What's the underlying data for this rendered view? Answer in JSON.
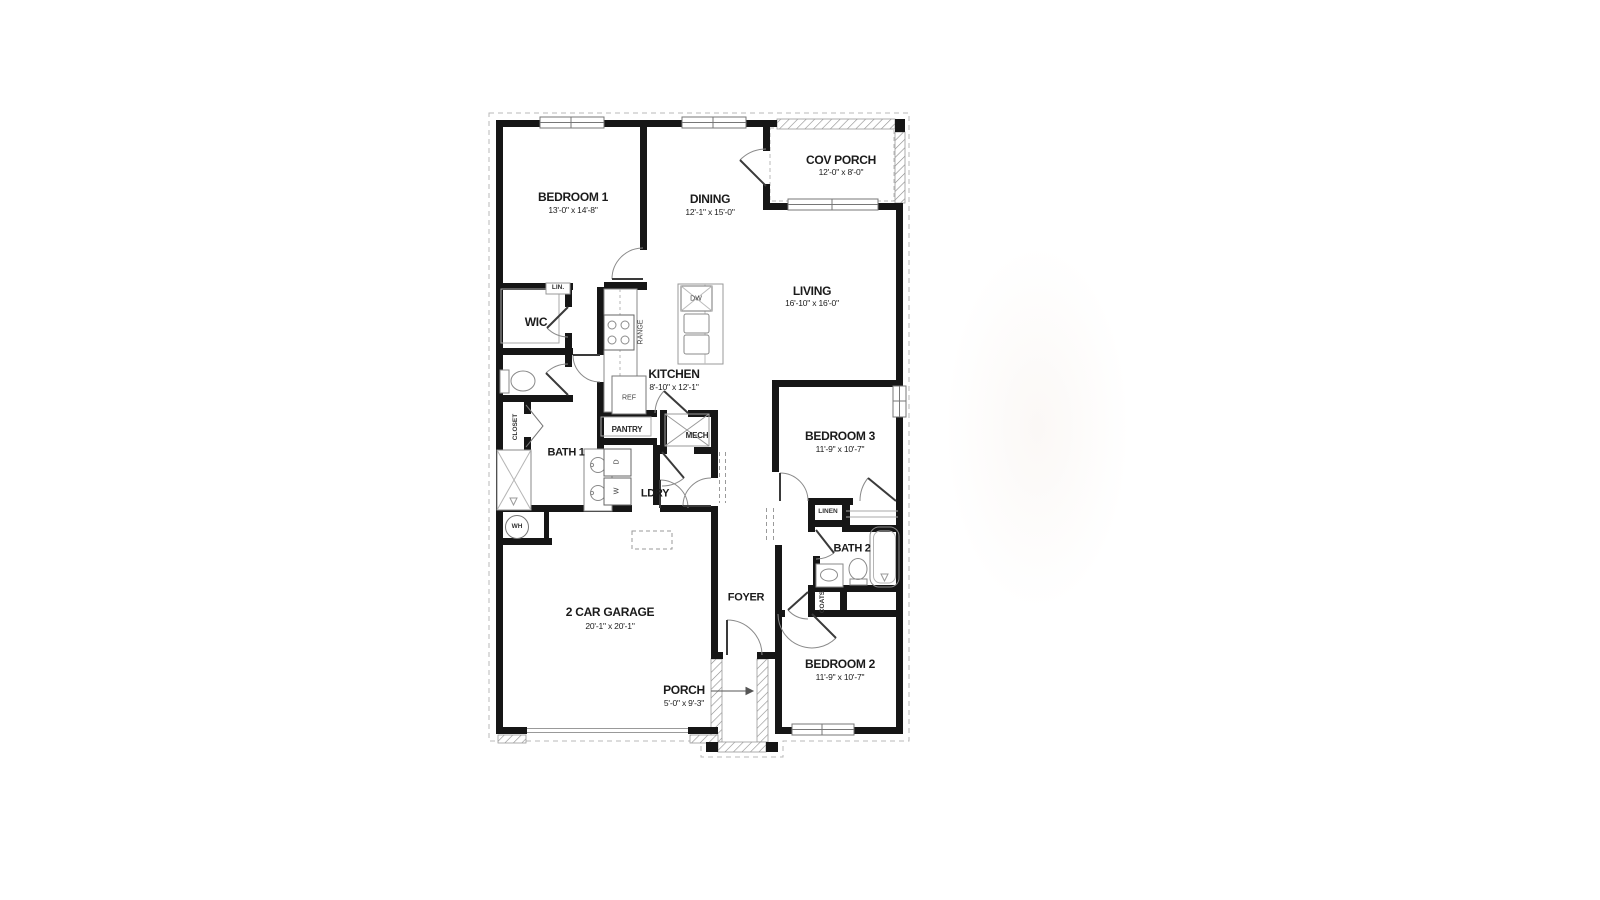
{
  "plan": {
    "rooms": {
      "bedroom1": {
        "name": "BEDROOM 1",
        "dims": "13'-0\" x 14'-8\""
      },
      "dining": {
        "name": "DINING",
        "dims": "12'-1\" x 15'-0\""
      },
      "cov_porch": {
        "name": "COV PORCH",
        "dims": "12'-0\" x 8'-0\""
      },
      "living": {
        "name": "LIVING",
        "dims": "16'-10\" x 16'-0\""
      },
      "kitchen": {
        "name": "KITCHEN",
        "dims": "8'-10\" x 12'-1\""
      },
      "bedroom3": {
        "name": "BEDROOM 3",
        "dims": "11'-9\" x 10'-7\""
      },
      "bedroom2": {
        "name": "BEDROOM 2",
        "dims": "11'-9\" x 10'-7\""
      },
      "garage": {
        "name": "2 CAR GARAGE",
        "dims": "20'-1\" x 20'-1\""
      },
      "porch": {
        "name": "PORCH",
        "dims": "5'-0\" x 9'-3\""
      },
      "foyer": {
        "name": "FOYER"
      },
      "bath1": {
        "name": "BATH 1"
      },
      "bath2": {
        "name": "BATH 2"
      },
      "wic": {
        "name": "WIC"
      },
      "ldry": {
        "name": "LDRY"
      }
    },
    "fixtures": {
      "pantry": "PANTRY",
      "mech": "MECH",
      "closet": "CLOSET",
      "lin": "LIN.",
      "linen": "LINEN",
      "coats": "COATS",
      "wh": "WH",
      "dw": "DW",
      "ref": "REF",
      "range": "RANGE",
      "dryer": "D",
      "washer": "W"
    },
    "colors": {
      "wall": "#161616",
      "line": "#8a8a8a",
      "light": "#b9b9b9"
    }
  }
}
